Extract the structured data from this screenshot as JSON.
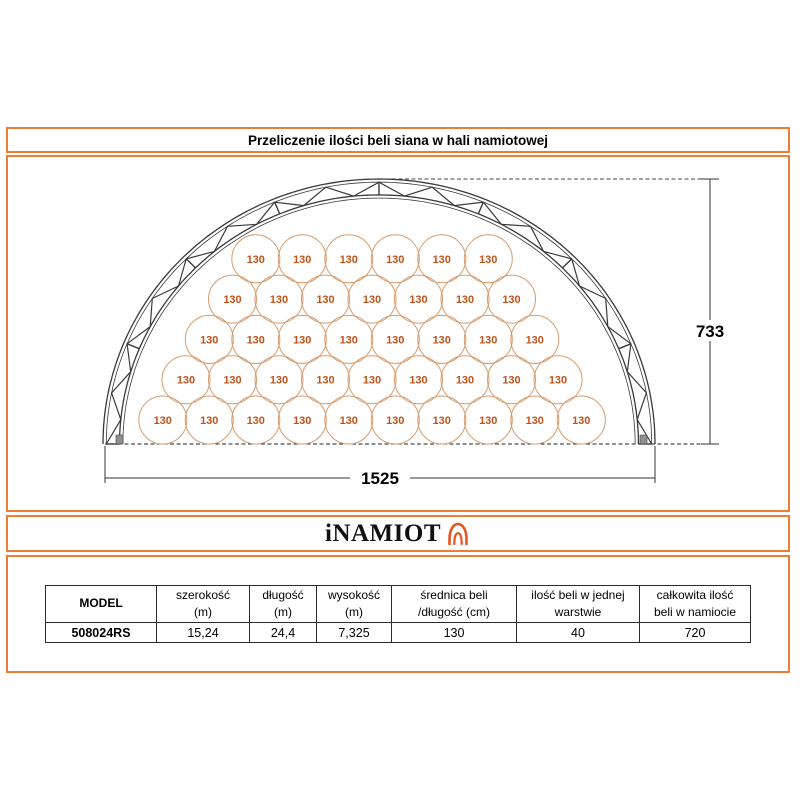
{
  "title": "Przeliczenie ilości beli siana w hali namiotowej",
  "logo": {
    "text": "iNAMIOT"
  },
  "diagram": {
    "bale_label": "130",
    "rows_top_to_bottom": [
      6,
      7,
      8,
      9,
      10
    ],
    "bales_per_layer": 40,
    "height_dim_label": "733",
    "width_dim_label": "1525",
    "colors": {
      "accent_orange": "#ED7D31",
      "bale_outline": "#D89B6C",
      "bale_text": "#C0531A",
      "truss": "#3a3a3a",
      "dimension": "#333333"
    }
  },
  "table": {
    "headers": [
      [
        "MODEL"
      ],
      [
        "szerokość",
        "(m)"
      ],
      [
        "długość",
        "(m)"
      ],
      [
        "wysokość",
        "(m)"
      ],
      [
        "średnica beli",
        "/długość (cm)"
      ],
      [
        "ilość beli w jednej",
        "warstwie"
      ],
      [
        "całkowita ilość",
        "beli w namiocie"
      ]
    ],
    "row": [
      "508024RS",
      "15,24",
      "24,4",
      "7,325",
      "130",
      "40",
      "720"
    ]
  }
}
